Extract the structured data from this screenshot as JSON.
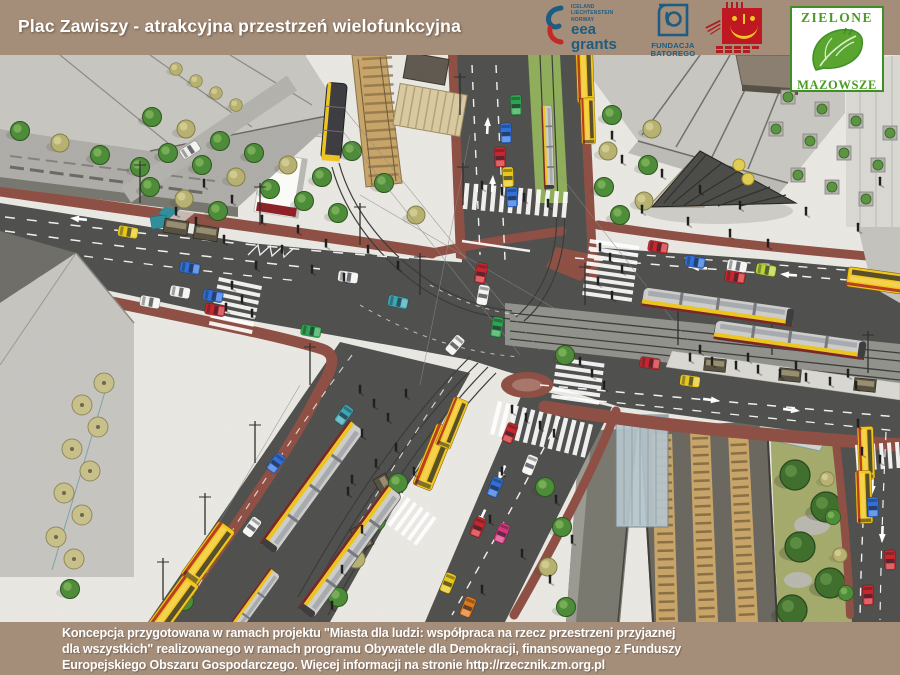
{
  "header": {
    "title": "Plac Zawiszy - atrakcyjna przestrzeń wielofunkcyjna"
  },
  "logos": {
    "eea_grants": {
      "countries": "ICELAND\nLIECHTENSTEIN\nNORWAY",
      "name_line1": "eea",
      "name_line2": "grants"
    },
    "batory": {
      "name": "FUNDACJA\nBATOREGO"
    },
    "zielone_mazowsze": {
      "top": "ZIELONE",
      "bottom": "MAZOWSZE"
    }
  },
  "footer": {
    "text": "Koncepcja przygotowana w ramach projektu \"Miasta dla ludzi: współpraca na rzecz przestrzeni przyjaznej\ndla wszystkich\" realizowanego w ramach programu Obywatele dla Demokracji, finansowanego z Funduszy\nEuropejskiego Obszaru Gospodarczego. Więcej informacji na stronie http://rzecznik.zm.org.pl"
  },
  "scene": {
    "subject": "aerial 3D visualization of Plac Zawiszy intersection with trams, buses, cars, pedestrians, railway trench and plazas",
    "colors": {
      "bar": "#a48d79",
      "plaza": "#e9e8e3",
      "road": "#4f4f4d",
      "bike_path": "#8e4f44",
      "bus_yellow": "#f3c71b",
      "tram_body": "#cdcdca",
      "tram_stripe": "#edc51e",
      "park_green": "#a4ab6c",
      "rail_ballast": "#c8a468",
      "water": "#2f8e9b"
    }
  }
}
